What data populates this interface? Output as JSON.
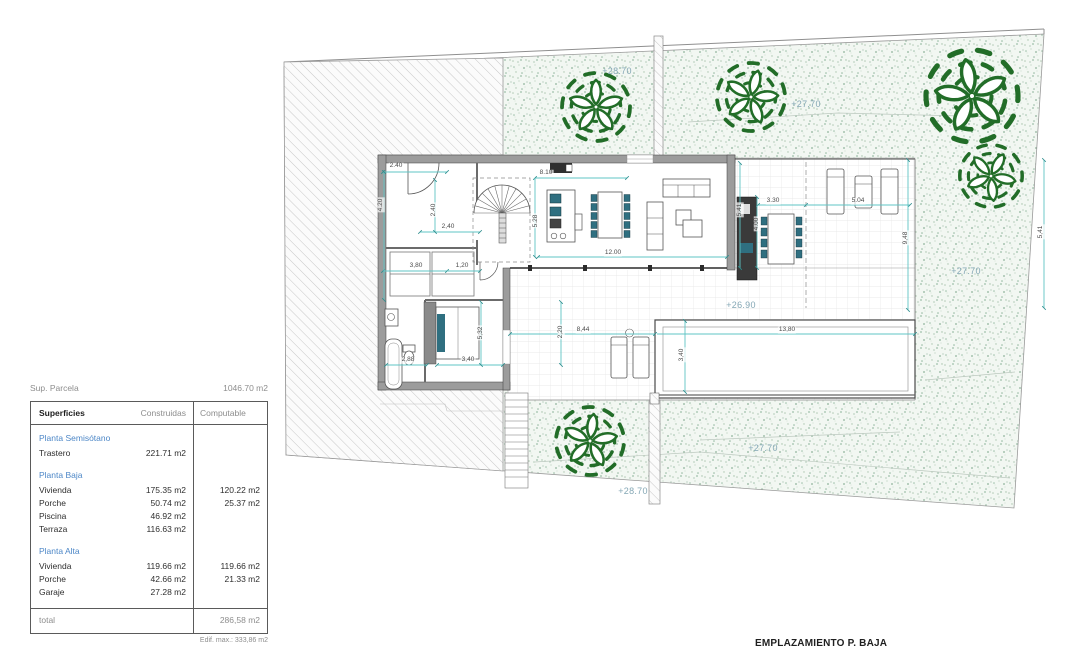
{
  "summary": {
    "label": "Sup. Parcela",
    "value": "1046.70 m2"
  },
  "table": {
    "headers": [
      "Superficies",
      "Construidas",
      "Computable"
    ],
    "sections": [
      {
        "title": "Planta Semisótano",
        "rows": [
          {
            "name": "Trastero",
            "construidas": "221.71 m2",
            "computable": ""
          }
        ]
      },
      {
        "title": "Planta Baja",
        "rows": [
          {
            "name": "Vivienda",
            "construidas": "175.35 m2",
            "computable": "120.22 m2"
          },
          {
            "name": "Porche",
            "construidas": "50.74 m2",
            "computable": "25.37 m2"
          },
          {
            "name": "Piscina",
            "construidas": "46.92 m2",
            "computable": ""
          },
          {
            "name": "Terraza",
            "construidas": "116.63 m2",
            "computable": ""
          }
        ]
      },
      {
        "title": "Planta Alta",
        "rows": [
          {
            "name": "Vivienda",
            "construidas": "119.66 m2",
            "computable": "119.66 m2"
          },
          {
            "name": "Porche",
            "construidas": "42.66 m2",
            "computable": "21.33 m2"
          },
          {
            "name": "Garaje",
            "construidas": "27.28 m2",
            "computable": ""
          }
        ]
      }
    ],
    "total": {
      "name": "total",
      "computable": "286,58 m2"
    },
    "footnote": "Edif. max.: 333,86 m2"
  },
  "plan": {
    "title": "EMPLAZAMIENTO P. BAJA",
    "colors": {
      "dimension_line": "#5fc4c4",
      "elevation_text": "#84a7b5",
      "tree_green": "#226d28",
      "wall_gray": "#9c9c9c",
      "accent_teal": "#2f6f80",
      "table_blue": "#4d87c7",
      "garden_dot": "#9dbfa9"
    },
    "elevations": [
      {
        "text": "+28.70",
        "x": 617,
        "y": 71
      },
      {
        "text": "+27.70",
        "x": 806,
        "y": 104
      },
      {
        "text": "+27.70",
        "x": 966,
        "y": 271
      },
      {
        "text": "+26.90",
        "x": 741,
        "y": 305
      },
      {
        "text": "+28.70",
        "x": 633,
        "y": 491
      },
      {
        "text": "+27.70",
        "x": 763,
        "y": 448
      }
    ],
    "dimensions": [
      {
        "text": "2.40",
        "x": 396,
        "y": 166,
        "rot": false
      },
      {
        "text": "4.20",
        "x": 381,
        "y": 205,
        "rot": true
      },
      {
        "text": "2.40",
        "x": 434,
        "y": 210,
        "rot": true
      },
      {
        "text": "2,40",
        "x": 448,
        "y": 227,
        "rot": false
      },
      {
        "text": "3,80",
        "x": 416,
        "y": 266,
        "rot": false
      },
      {
        "text": "1,20",
        "x": 462,
        "y": 266,
        "rot": false
      },
      {
        "text": "2,88",
        "x": 408,
        "y": 360,
        "rot": false
      },
      {
        "text": "3,40",
        "x": 468,
        "y": 360,
        "rot": false
      },
      {
        "text": "5,32",
        "x": 481,
        "y": 333,
        "rot": true
      },
      {
        "text": "8.10",
        "x": 546,
        "y": 173,
        "rot": false
      },
      {
        "text": "5.28",
        "x": 536,
        "y": 221,
        "rot": true
      },
      {
        "text": "12.00",
        "x": 613,
        "y": 253,
        "rot": false
      },
      {
        "text": "5.41",
        "x": 740,
        "y": 210,
        "rot": true
      },
      {
        "text": "4.00",
        "x": 757,
        "y": 224,
        "rot": true
      },
      {
        "text": "3.30",
        "x": 773,
        "y": 201,
        "rot": false
      },
      {
        "text": "5.04",
        "x": 858,
        "y": 201,
        "rot": false
      },
      {
        "text": "9,48",
        "x": 906,
        "y": 238,
        "rot": true
      },
      {
        "text": "8,44",
        "x": 583,
        "y": 330,
        "rot": false
      },
      {
        "text": "13,80",
        "x": 787,
        "y": 330,
        "rot": false
      },
      {
        "text": "3,40",
        "x": 682,
        "y": 355,
        "rot": true
      },
      {
        "text": "2,20",
        "x": 561,
        "y": 332,
        "rot": true
      },
      {
        "text": "5,41",
        "x": 1041,
        "y": 232,
        "rot": true
      }
    ]
  }
}
